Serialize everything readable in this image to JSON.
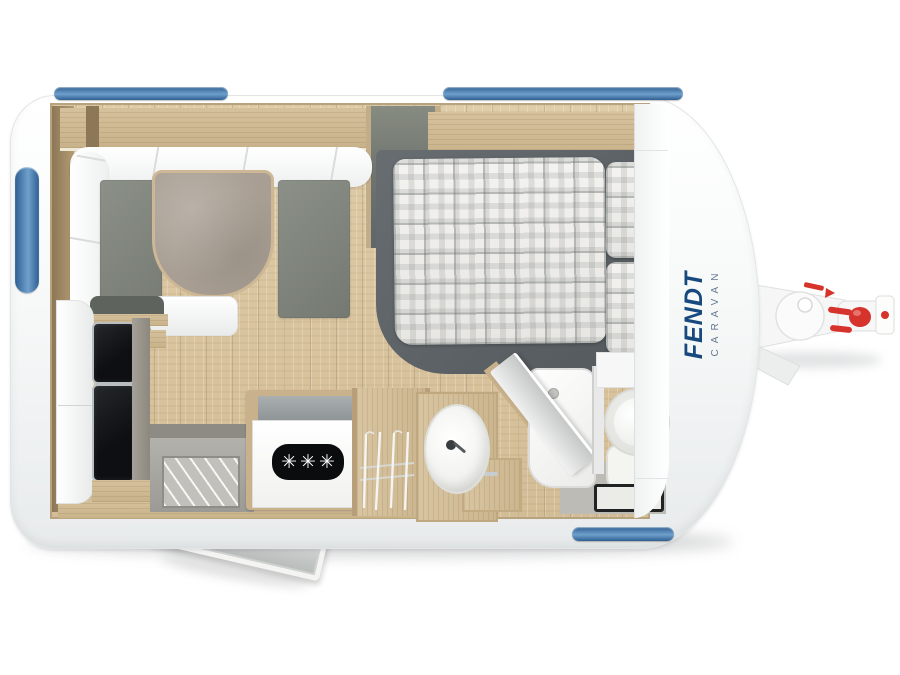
{
  "brand": {
    "name": "FENDT",
    "subtitle": "CARAVAN"
  },
  "stove": {
    "burner_glyph": "✳",
    "burner_count": 3
  },
  "colors": {
    "brand_blue": "#17497E",
    "brand_sub": "#64788E",
    "window_blue": "#2F5F92",
    "window_blue_light": "#6FA0CC",
    "hitch_red": "#D6332C",
    "shell_white": "#FBFCFC",
    "floor_wood": "#D9C7A2",
    "furniture_wood": "#CDB691",
    "cushion_gray": "#81867E",
    "bed_gray": "#5C6267",
    "table_gray": "#A89E93",
    "appliance_black": "#15171A"
  }
}
